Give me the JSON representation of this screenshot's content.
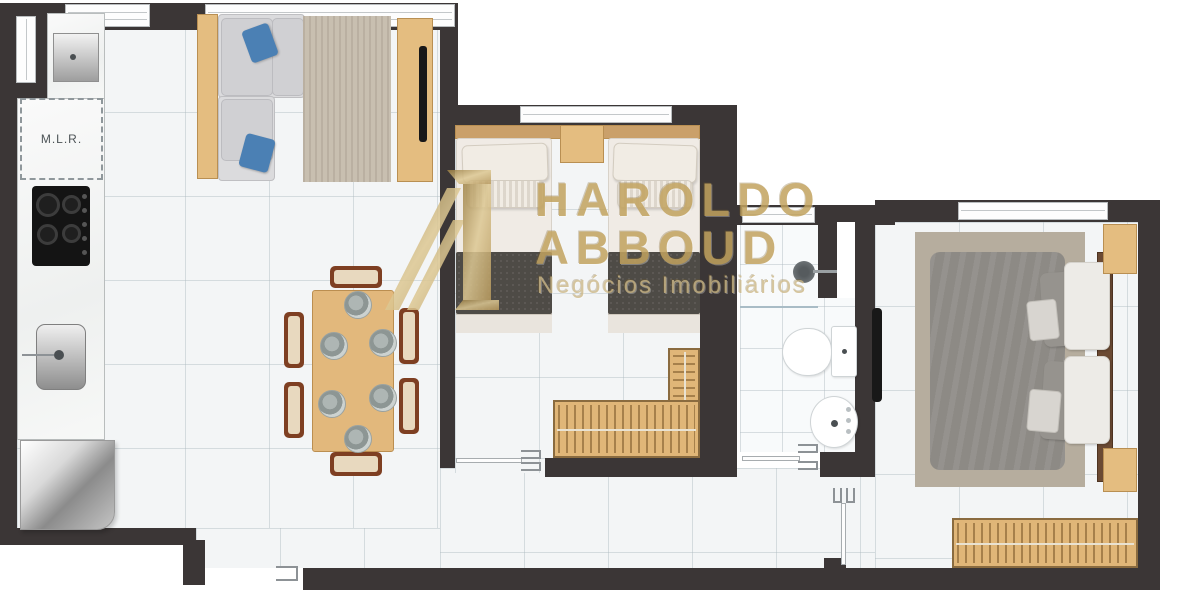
{
  "plan": {
    "labels": {
      "laundry_area": "M.L.R."
    },
    "watermark": {
      "brand_line1": "HAROLDO",
      "brand_line2": "ABBOUD",
      "tagline": "Negócios Imobiliários"
    },
    "colors": {
      "wall": "#3b3636",
      "floor_tile": "#f3f5f6",
      "wood_light": "#e4bd80",
      "wood_dark": "#6b4a33",
      "chair_wood": "#7e3f22",
      "pillow_blue": "#4b80b4",
      "blanket_dark": "#4e4b46",
      "duvet_gray": "#8d8a85",
      "rug_living": "#c8bfb0",
      "rug_master": "#b6ad9e",
      "watermark_gold": "#c2a35f"
    },
    "furniture_icons": [
      "kitchen-sink-cabinet",
      "washing-machine-space",
      "cooktop",
      "kitchen-basin",
      "fridge",
      "l-shaped-sofa",
      "living-rug",
      "tv-console",
      "tv",
      "dining-table",
      "dining-chairs",
      "plates",
      "single-bed-left",
      "single-bed-right",
      "nightstand",
      "l-shaped-wardrobe",
      "shower-head",
      "shower-glass",
      "toilet",
      "washbasin",
      "double-bed",
      "master-rug",
      "master-nightstands",
      "master-wardrobe",
      "wall-tv",
      "windows",
      "door-swing-marks"
    ]
  }
}
